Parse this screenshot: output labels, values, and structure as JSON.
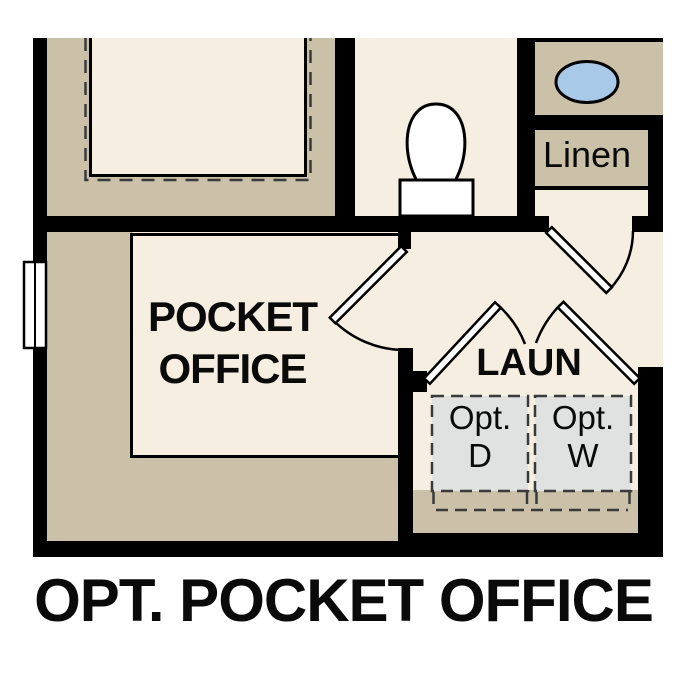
{
  "title": "OPT. POCKET OFFICE",
  "colors": {
    "bg": "#ffffff",
    "wall": "#000000",
    "floor": "#f5eee1",
    "poche": "#cbc0a8",
    "appliance": "#dfe2e1",
    "sink": "#a9c9e9",
    "dash": "#3a3a3a"
  },
  "rooms": {
    "pocket_office": {
      "line1": "POCKET",
      "line2": "OFFICE"
    },
    "laundry": {
      "label": "LAUN"
    },
    "linen": {
      "label": "Linen"
    },
    "dryer": {
      "line1": "Opt.",
      "line2": "D"
    },
    "washer": {
      "line1": "Opt.",
      "line2": "W"
    }
  }
}
